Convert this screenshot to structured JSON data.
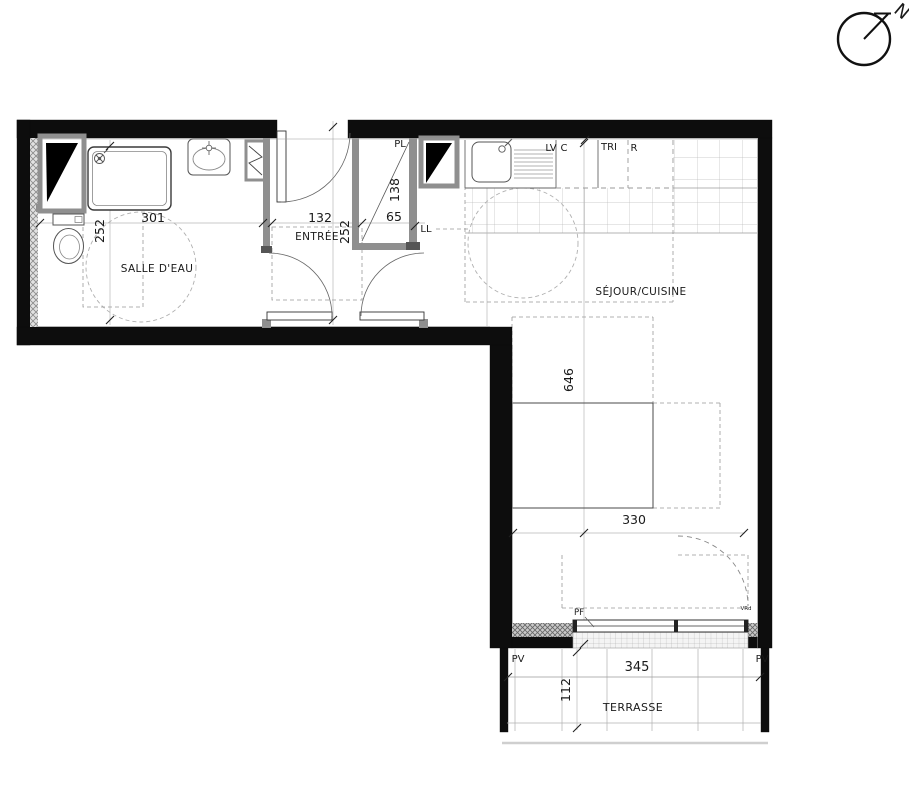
{
  "colors": {
    "wall": "#0d0d0d",
    "partition": "#8f8f8f",
    "dashed_zone": "#999999",
    "chain_line": "#b8b8b8",
    "tile_line": "#bdbdbd"
  },
  "rooms": {
    "salle_deau": {
      "label": "SALLE D'EAU",
      "dim_width": "301",
      "dim_height": "252"
    },
    "entree": {
      "label": "ENTRÉE",
      "dim_width": "132",
      "dim_height": "252"
    },
    "placard": {
      "label": "PL",
      "dim_width": "65",
      "dim_depth": "138"
    },
    "sejour_cuisine": {
      "label": "SÉJOUR/CUISINE",
      "dim_height": "646",
      "dim_width": "330"
    },
    "terrasse": {
      "label": "TERRASSE",
      "dim_width": "345",
      "dim_depth": "112"
    }
  },
  "kitchen": {
    "lv": "LV",
    "c": "C",
    "tri": "TRI",
    "r": "R"
  },
  "annotations": {
    "ll": "LL",
    "pf": "PF",
    "pv_left": "PV",
    "pv_right": "PV",
    "vr": "VRd"
  },
  "compass": {
    "north": "N"
  }
}
